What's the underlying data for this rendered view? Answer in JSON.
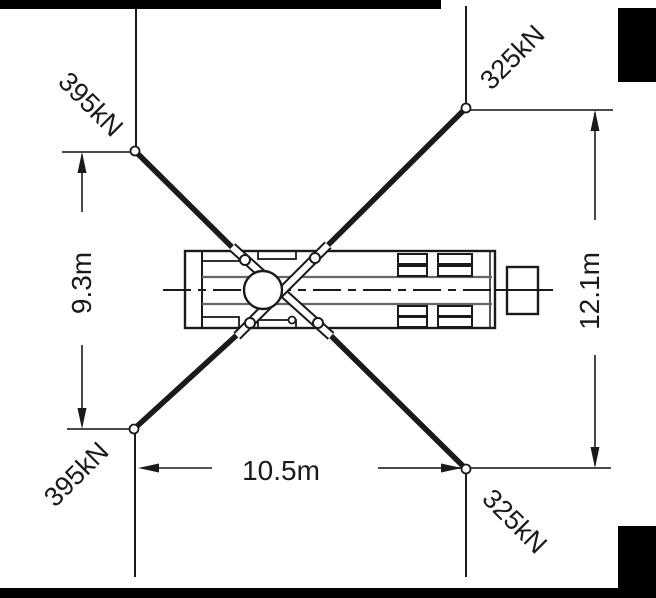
{
  "diagram": {
    "title": "Crane outrigger load plan view",
    "loads": {
      "top_left": "395kN",
      "top_right": "325kN",
      "bottom_left": "395kN",
      "bottom_right": "325kN"
    },
    "dimensions": {
      "left_vertical": "9.3m",
      "right_vertical": "12.1m",
      "bottom_horizontal": "10.5m"
    },
    "colors": {
      "ink": "#1a1a1a",
      "dim_line": "#4a4a4a",
      "rail": "#666666",
      "background": "#ffffff",
      "mask": "#000000"
    }
  }
}
